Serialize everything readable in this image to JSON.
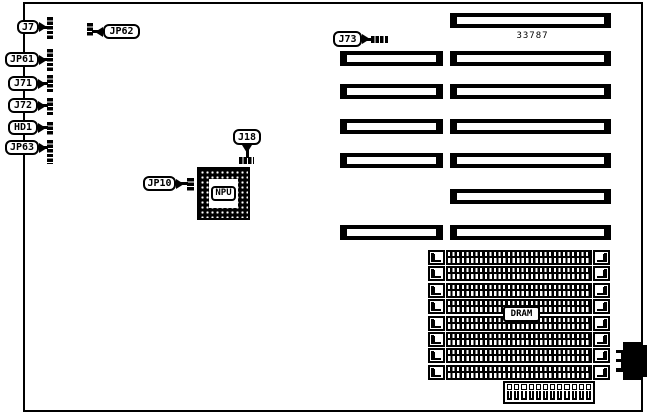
{
  "board": {
    "title": "motherboard jumper and connector diagram",
    "part_number": "33787"
  },
  "callouts": {
    "j7": {
      "label": "J7"
    },
    "jp61": {
      "label": "JP61"
    },
    "j71": {
      "label": "J71"
    },
    "j72": {
      "label": "J72"
    },
    "hd1": {
      "label": "HD1"
    },
    "jp63": {
      "label": "JP63"
    },
    "jp62": {
      "label": "JP62"
    },
    "j73": {
      "label": "J73"
    },
    "j18": {
      "label": "J18"
    },
    "jp10": {
      "label": "JP10"
    }
  },
  "chip": {
    "label": "NPU"
  },
  "memory": {
    "label": "DRAM",
    "simm_socket_count": 8
  },
  "slots": {
    "long_segment_count": 7,
    "short_segment_count": 5
  },
  "power_connector": {
    "pin_count_top": 12,
    "pin_count_bottom": 12
  }
}
